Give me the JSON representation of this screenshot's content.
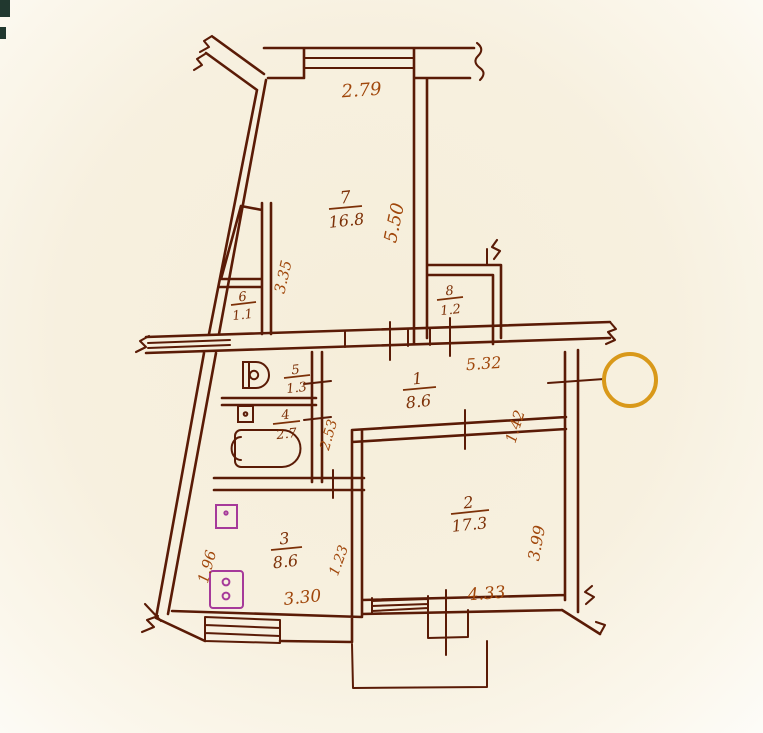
{
  "colors": {
    "paper": "#f6eeda",
    "ink": "#5a1b06",
    "label_ink": "#7c3007",
    "dim_ink": "#a0470b",
    "fixture_purple": "#a63a9a",
    "marker_orange": "#d9991a"
  },
  "plan": {
    "type": "apartment-floor-plan-scan",
    "rooms": [
      {
        "number": "7",
        "area": "16.8"
      },
      {
        "number": "6",
        "area": "1.1"
      },
      {
        "number": "8",
        "area": "1.2"
      },
      {
        "number": "5",
        "area": "1.3"
      },
      {
        "number": "4",
        "area": "2.7"
      },
      {
        "number": "1",
        "area": "8.6"
      },
      {
        "number": "2",
        "area": "17.3"
      },
      {
        "number": "3",
        "area": "8.6"
      }
    ],
    "dimensions": [
      {
        "value": "2.79"
      },
      {
        "value": "5.50"
      },
      {
        "value": "3.35"
      },
      {
        "value": "5.32"
      },
      {
        "value": "1.42"
      },
      {
        "value": "2.53"
      },
      {
        "value": "1.96"
      },
      {
        "value": "1.23"
      },
      {
        "value": "3.30"
      },
      {
        "value": "3.99"
      },
      {
        "value": "4.33"
      }
    ]
  }
}
